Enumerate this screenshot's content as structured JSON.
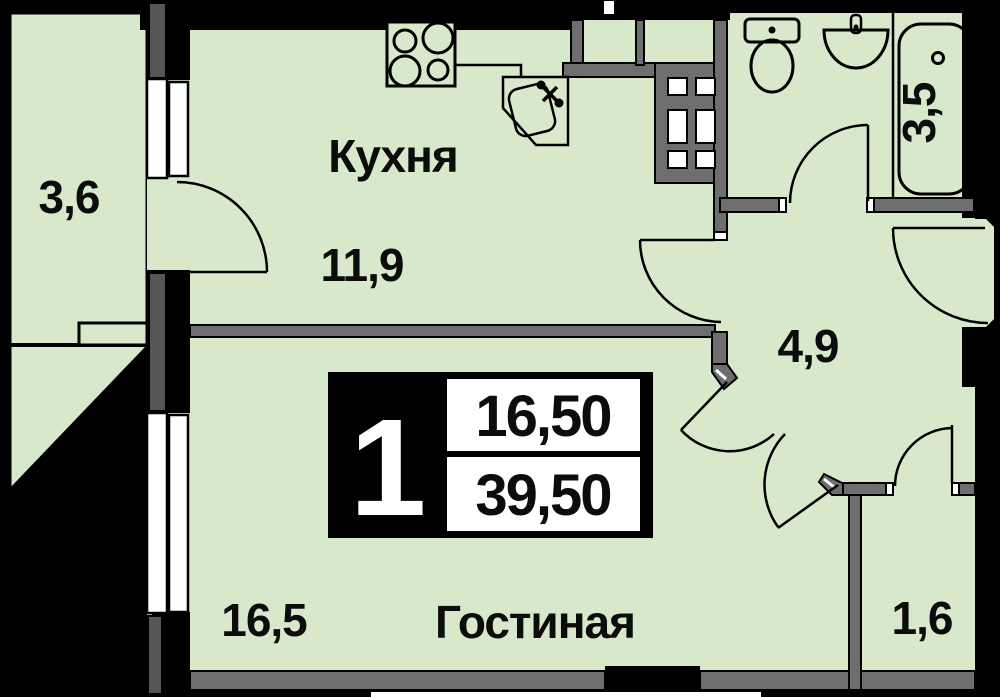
{
  "plan": {
    "title": "apartment-floor-plan",
    "rooms": {
      "balcony": {
        "area": "3,6"
      },
      "kitchen": {
        "name": "Кухня",
        "area": "11,9"
      },
      "bathroom": {
        "area": "3,5"
      },
      "hallway": {
        "area": "4,9"
      },
      "living": {
        "name": "Гостиная",
        "area": "16,5"
      },
      "storage": {
        "area": "1,6"
      }
    },
    "badge": {
      "rooms_count": "1",
      "living_area": "16,50",
      "total_area": "39,50"
    },
    "colors": {
      "floor_green": "#d8e8cb",
      "wall_gray": "#6e6e6e",
      "pillar_gray": "#555555",
      "outline_black": "#000000",
      "window_white": "#ffffff",
      "background": "#000000"
    }
  }
}
